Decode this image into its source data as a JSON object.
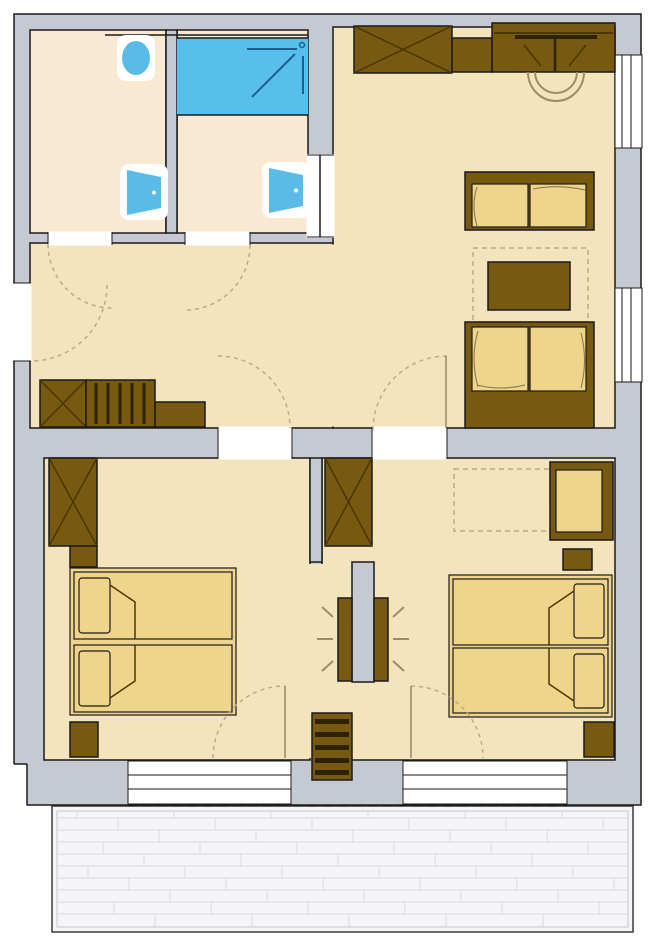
{
  "document": {
    "kind": "architectural floor plan",
    "description": "upper-storey apartment plan with two bathrooms, open hallway and living room, two bedrooms and a terrace; no text labels are printed on the drawing"
  },
  "colors": {
    "wall": "#C5C9D2",
    "wallLine": "#1a1a1a",
    "floorMain": "#F4E4BE",
    "floorBath": "#FAE9D2",
    "mattress": "#EFD48C",
    "furniture": "#775A10",
    "furnitureDark": "#2E2300",
    "furnitureMid": "#4A3600",
    "tub": "#57BFEB",
    "fixture": "#5ABCE6",
    "showerLine": "#1E5E8C",
    "dash": "#BCA98B",
    "dashSolid": "#8A7A55",
    "curveLine": "#8A7A45",
    "chairLine": "#A08A64",
    "terraceFill": "#F5F5F7",
    "terraceInner": "#C2C6CC",
    "terraceBorder": "#3a3a3a",
    "terracePlank": "#D9DADE"
  },
  "rooms": [
    {
      "id": "wc",
      "features": [
        "toilet",
        "wash-basin"
      ]
    },
    {
      "id": "bathroom",
      "features": [
        "bathtub-with-shower",
        "wash-basin"
      ]
    },
    {
      "id": "hallway",
      "features": [
        "staircase",
        "shaft",
        "entrance-door"
      ]
    },
    {
      "id": "living-room",
      "features": [
        "wardrobe",
        "kitchenette-counter",
        "two-sofas",
        "coffee-table",
        "rug"
      ]
    },
    {
      "id": "bedroom-left",
      "features": [
        "wardrobe",
        "double-bed",
        "nightstands",
        "terrace-door"
      ]
    },
    {
      "id": "bedroom-right",
      "features": [
        "wardrobe",
        "double-bed",
        "desk",
        "nightstands",
        "terrace-door",
        "planned-furniture-dashed"
      ]
    },
    {
      "id": "terrace",
      "features": [
        "plank-decking"
      ]
    }
  ],
  "openings": {
    "windows_right_wall": 2,
    "terrace_glazing_panels": 2,
    "interior_door_arcs": 7
  },
  "symbols": [
    "x-crossed-box = wardrobe/shaft",
    "dashed-quarter-circle = door swing",
    "striped-box = staircase",
    "radiating-lines = stove/chimney between bedrooms"
  ]
}
